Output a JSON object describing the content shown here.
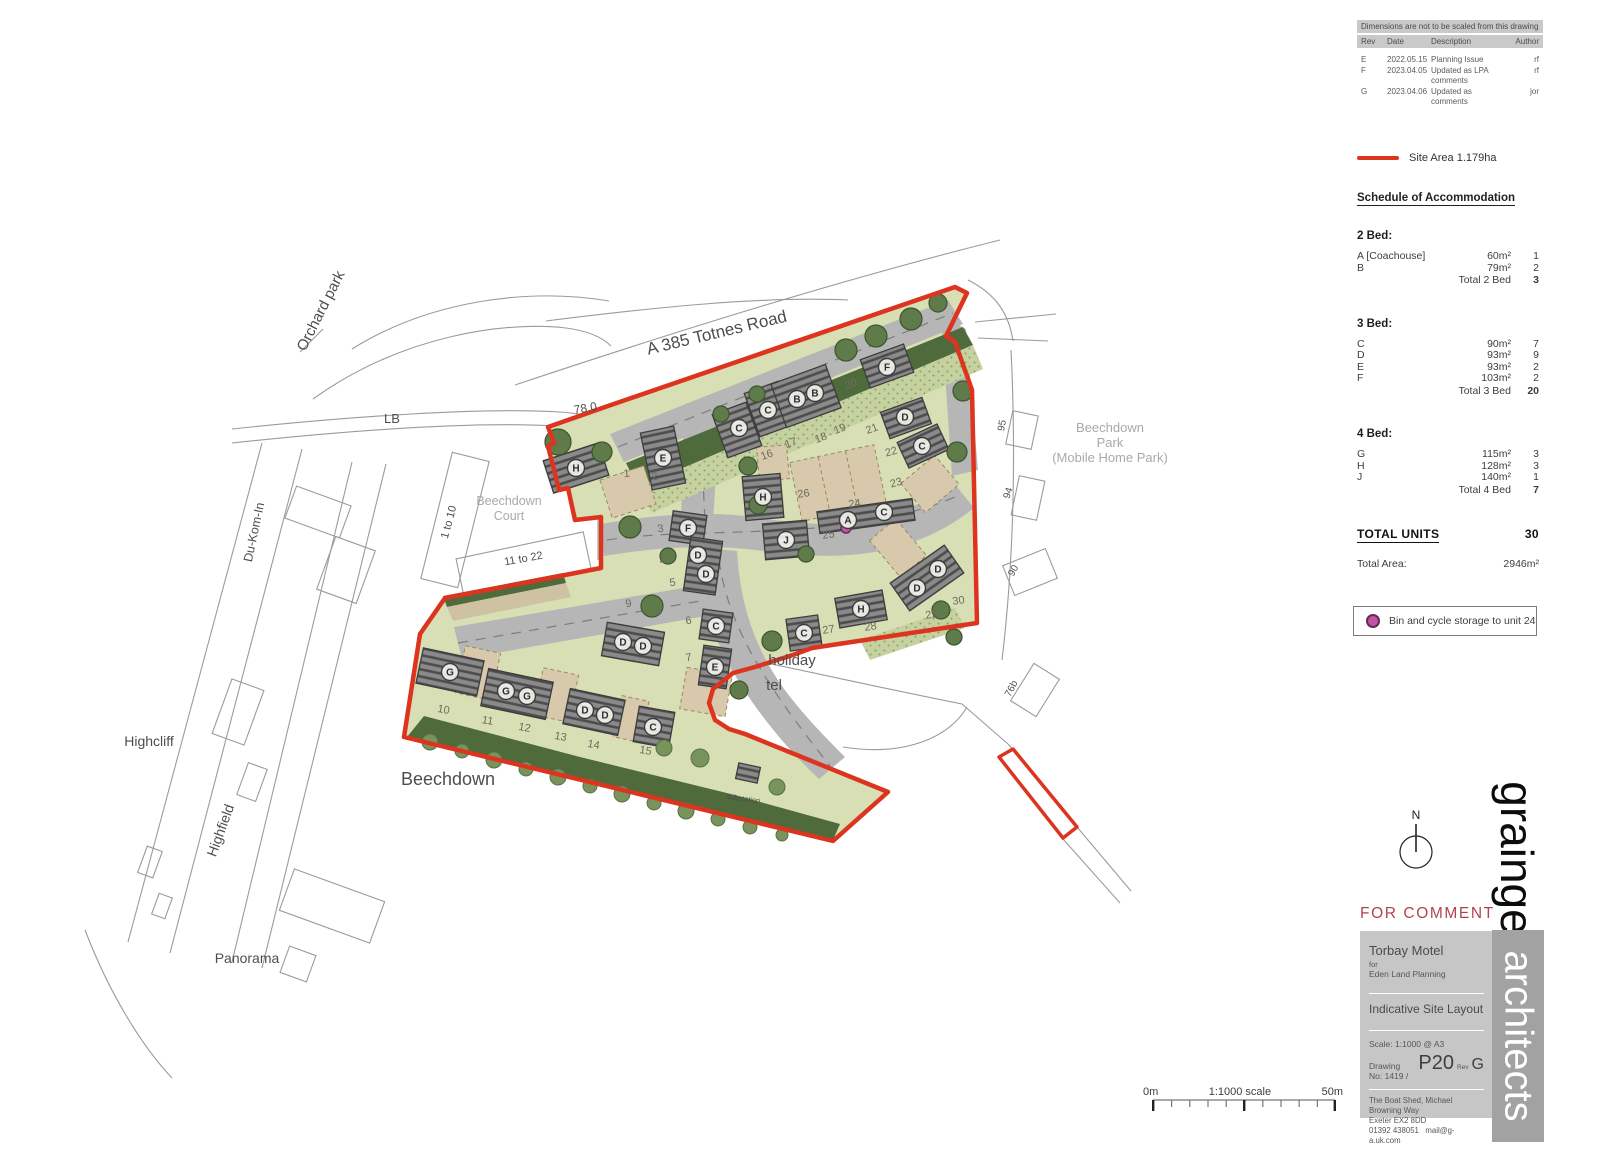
{
  "revisions_panel": {
    "note": "Dimensions are not to be scaled from this drawing",
    "columns": [
      "Rev",
      "Date",
      "Description",
      "Author"
    ],
    "rows": [
      {
        "rev": "E",
        "date": "2022.05.15",
        "description": "Planning Issue",
        "author": "rf"
      },
      {
        "rev": "F",
        "date": "2023.04.05",
        "description": "Updated as LPA comments",
        "author": "rf"
      },
      {
        "rev": "G",
        "date": "2023.04.06",
        "description": "Updated as comments",
        "author": "jor"
      }
    ]
  },
  "legend": {
    "site_area_label": "Site Area 1.179ha",
    "bin_note": "Bin and cycle storage to unit 24",
    "accent_red": "#dd3420",
    "bin_dot_color": "#bf55a1"
  },
  "schedule": {
    "title": "Schedule of Accommodation",
    "groups": [
      {
        "heading": "2 Bed:",
        "rows": [
          {
            "type": "A [Coachouse]",
            "area": "60m²",
            "count": "1"
          },
          {
            "type": "B",
            "area": "79m²",
            "count": "2"
          }
        ],
        "total_label": "Total 2 Bed",
        "total": "3"
      },
      {
        "heading": "3 Bed:",
        "rows": [
          {
            "type": "C",
            "area": "90m²",
            "count": "7"
          },
          {
            "type": "D",
            "area": "93m²",
            "count": "9"
          },
          {
            "type": "E",
            "area": "93m²",
            "count": "2"
          },
          {
            "type": "F",
            "area": "103m²",
            "count": "2"
          }
        ],
        "total_label": "Total 3 Bed",
        "total": "20"
      },
      {
        "heading": "4 Bed:",
        "rows": [
          {
            "type": "G",
            "area": "115m²",
            "count": "3"
          },
          {
            "type": "H",
            "area": "128m²",
            "count": "3"
          },
          {
            "type": "J",
            "area": "140m²",
            "count": "1"
          }
        ],
        "total_label": "Total 4 Bed",
        "total": "7"
      }
    ],
    "total_units_label": "TOTAL UNITS",
    "total_units": "30",
    "total_area_label": "Total Area:",
    "total_area": "2946m²"
  },
  "status_stamp": "FOR COMMENT",
  "title_block": {
    "project": "Torbay Motel",
    "for_label": "for",
    "client": "Eden Land Planning",
    "drawing_title": "Indicative Site Layout",
    "scale_label": "Scale:",
    "scale": "1:1000 @ A3",
    "drawing_no_label": "Drawing No:  1419 /",
    "sheet": "P20",
    "rev_label": "Rev",
    "rev": "G",
    "address_line1": "The Boat Shed, Michael Browning Way",
    "address_line2": "Exeter EX2 8DD",
    "phone": "01392 438051",
    "email": "mail@g-a.uk.com"
  },
  "branding": {
    "name": "grainge",
    "suffix": "architects"
  },
  "north_arrow_label": "N",
  "scale_bar": {
    "left": "0m",
    "center": "1:1000 scale",
    "right": "50m"
  },
  "map": {
    "street_labels": [
      {
        "text": "Orchard park",
        "x": 325,
        "y": 313,
        "rot": -63,
        "size": 15,
        "tone": "dark"
      },
      {
        "text": "LB",
        "x": 392,
        "y": 423,
        "rot": 0,
        "size": 13,
        "tone": "dark"
      },
      {
        "text": "A 385 Totnes Road",
        "x": 718,
        "y": 338,
        "rot": -13.5,
        "size": 17,
        "tone": "dark"
      },
      {
        "text": "78.0",
        "x": 586,
        "y": 412,
        "rot": -10,
        "size": 12,
        "tone": "dark"
      },
      {
        "text": "Du-Kom-In",
        "x": 258,
        "y": 533,
        "rot": -78,
        "size": 12.5,
        "tone": "dark"
      },
      {
        "text": "1 to 10",
        "x": 452,
        "y": 523,
        "rot": -75,
        "size": 11,
        "tone": "dark"
      },
      {
        "text": "Beechdown",
        "x": 509,
        "y": 505,
        "rot": 0,
        "size": 12.5,
        "tone": "gray"
      },
      {
        "text": "Court",
        "x": 509,
        "y": 520,
        "rot": 0,
        "size": 12.5,
        "tone": "gray"
      },
      {
        "text": "11 to 22",
        "x": 524,
        "y": 562,
        "rot": -10,
        "size": 11,
        "tone": "dark"
      },
      {
        "text": "Highcliff",
        "x": 149,
        "y": 746,
        "rot": 0,
        "size": 14,
        "tone": "dark"
      },
      {
        "text": "Highfield",
        "x": 225,
        "y": 832,
        "rot": -70,
        "size": 14,
        "tone": "dark"
      },
      {
        "text": "Panorama",
        "x": 247,
        "y": 963,
        "rot": 0,
        "size": 14,
        "tone": "dark"
      },
      {
        "text": "Beechdown",
        "x": 448,
        "y": 785,
        "rot": 0,
        "size": 18,
        "tone": "dark"
      },
      {
        "text": "holiday",
        "x": 792,
        "y": 665,
        "rot": 0,
        "size": 15,
        "tone": "dark"
      },
      {
        "text": "tel",
        "x": 774,
        "y": 690,
        "rot": 0,
        "size": 15,
        "tone": "dark"
      },
      {
        "text": "Beechdown",
        "x": 1110,
        "y": 432,
        "rot": 0,
        "size": 13,
        "tone": "gray"
      },
      {
        "text": "Park",
        "x": 1110,
        "y": 447,
        "rot": 0,
        "size": 13,
        "tone": "gray"
      },
      {
        "text": "(Mobile Home Park)",
        "x": 1110,
        "y": 462,
        "rot": 0,
        "size": 13,
        "tone": "gray"
      },
      {
        "text": "95",
        "x": 1005,
        "y": 426,
        "rot": -80,
        "size": 10,
        "tone": "dark"
      },
      {
        "text": "94",
        "x": 1011,
        "y": 494,
        "rot": -72,
        "size": 10,
        "tone": "dark"
      },
      {
        "text": "90",
        "x": 1016,
        "y": 572,
        "rot": -62,
        "size": 10,
        "tone": "dark"
      },
      {
        "text": "76b",
        "x": 1014,
        "y": 690,
        "rot": -62,
        "size": 10,
        "tone": "dark"
      },
      {
        "text": "substation",
        "x": 743,
        "y": 801,
        "rot": 8,
        "size": 7.5,
        "tone": "dark"
      }
    ],
    "plot_numbers": [
      {
        "n": "1",
        "x": 627,
        "y": 477,
        "rot": -8
      },
      {
        "n": "2",
        "x": 655,
        "y": 480,
        "rot": -8
      },
      {
        "n": "3",
        "x": 661,
        "y": 532,
        "rot": -8
      },
      {
        "n": "4",
        "x": 663,
        "y": 564,
        "rot": -8
      },
      {
        "n": "5",
        "x": 673,
        "y": 586,
        "rot": -8
      },
      {
        "n": "6",
        "x": 689,
        "y": 624,
        "rot": -8
      },
      {
        "n": "7",
        "x": 689,
        "y": 661,
        "rot": -8
      },
      {
        "n": "8",
        "x": 659,
        "y": 615,
        "rot": -8
      },
      {
        "n": "9",
        "x": 629,
        "y": 607,
        "rot": -8
      },
      {
        "n": "10",
        "x": 443,
        "y": 713,
        "rot": 10
      },
      {
        "n": "11",
        "x": 487,
        "y": 724,
        "rot": 10
      },
      {
        "n": "12",
        "x": 524,
        "y": 731,
        "rot": 10
      },
      {
        "n": "13",
        "x": 560,
        "y": 740,
        "rot": 10
      },
      {
        "n": "14",
        "x": 593,
        "y": 748,
        "rot": 10
      },
      {
        "n": "15",
        "x": 645,
        "y": 754,
        "rot": 10
      },
      {
        "n": "16",
        "x": 768,
        "y": 458,
        "rot": -20
      },
      {
        "n": "17",
        "x": 792,
        "y": 446,
        "rot": -20
      },
      {
        "n": "18",
        "x": 822,
        "y": 441,
        "rot": -20
      },
      {
        "n": "19",
        "x": 841,
        "y": 432,
        "rot": -20
      },
      {
        "n": "20",
        "x": 852,
        "y": 387,
        "rot": -20
      },
      {
        "n": "21",
        "x": 873,
        "y": 432,
        "rot": -20
      },
      {
        "n": "22",
        "x": 892,
        "y": 455,
        "rot": -15
      },
      {
        "n": "23",
        "x": 897,
        "y": 486,
        "rot": -15
      },
      {
        "n": "24",
        "x": 855,
        "y": 507,
        "rot": -8
      },
      {
        "n": "25",
        "x": 829,
        "y": 538,
        "rot": -8
      },
      {
        "n": "26",
        "x": 804,
        "y": 497,
        "rot": -8
      },
      {
        "n": "27",
        "x": 829,
        "y": 633,
        "rot": -8
      },
      {
        "n": "28",
        "x": 871,
        "y": 630,
        "rot": -8
      },
      {
        "n": "29",
        "x": 932,
        "y": 618,
        "rot": -8
      },
      {
        "n": "30",
        "x": 959,
        "y": 604,
        "rot": -8
      }
    ],
    "unit_markers": [
      {
        "u": "H",
        "x": 576,
        "y": 468
      },
      {
        "u": "E",
        "x": 663,
        "y": 458
      },
      {
        "u": "C",
        "x": 739,
        "y": 428
      },
      {
        "u": "C",
        "x": 768,
        "y": 410
      },
      {
        "u": "B",
        "x": 797,
        "y": 399
      },
      {
        "u": "B",
        "x": 815,
        "y": 393
      },
      {
        "u": "F",
        "x": 887,
        "y": 367
      },
      {
        "u": "D",
        "x": 905,
        "y": 417
      },
      {
        "u": "C",
        "x": 922,
        "y": 446
      },
      {
        "u": "H",
        "x": 763,
        "y": 497
      },
      {
        "u": "J",
        "x": 786,
        "y": 540
      },
      {
        "u": "A",
        "x": 848,
        "y": 520
      },
      {
        "u": "C",
        "x": 884,
        "y": 512
      },
      {
        "u": "F",
        "x": 688,
        "y": 528
      },
      {
        "u": "D",
        "x": 698,
        "y": 555
      },
      {
        "u": "D",
        "x": 706,
        "y": 574
      },
      {
        "u": "C",
        "x": 716,
        "y": 626
      },
      {
        "u": "E",
        "x": 715,
        "y": 667
      },
      {
        "u": "D",
        "x": 623,
        "y": 642
      },
      {
        "u": "D",
        "x": 643,
        "y": 646
      },
      {
        "u": "D",
        "x": 917,
        "y": 588
      },
      {
        "u": "D",
        "x": 938,
        "y": 569
      },
      {
        "u": "H",
        "x": 861,
        "y": 609
      },
      {
        "u": "C",
        "x": 804,
        "y": 633
      },
      {
        "u": "G",
        "x": 450,
        "y": 672
      },
      {
        "u": "G",
        "x": 506,
        "y": 691
      },
      {
        "u": "G",
        "x": 527,
        "y": 696
      },
      {
        "u": "D",
        "x": 585,
        "y": 710
      },
      {
        "u": "D",
        "x": 605,
        "y": 715
      },
      {
        "u": "C",
        "x": 653,
        "y": 727
      }
    ]
  }
}
